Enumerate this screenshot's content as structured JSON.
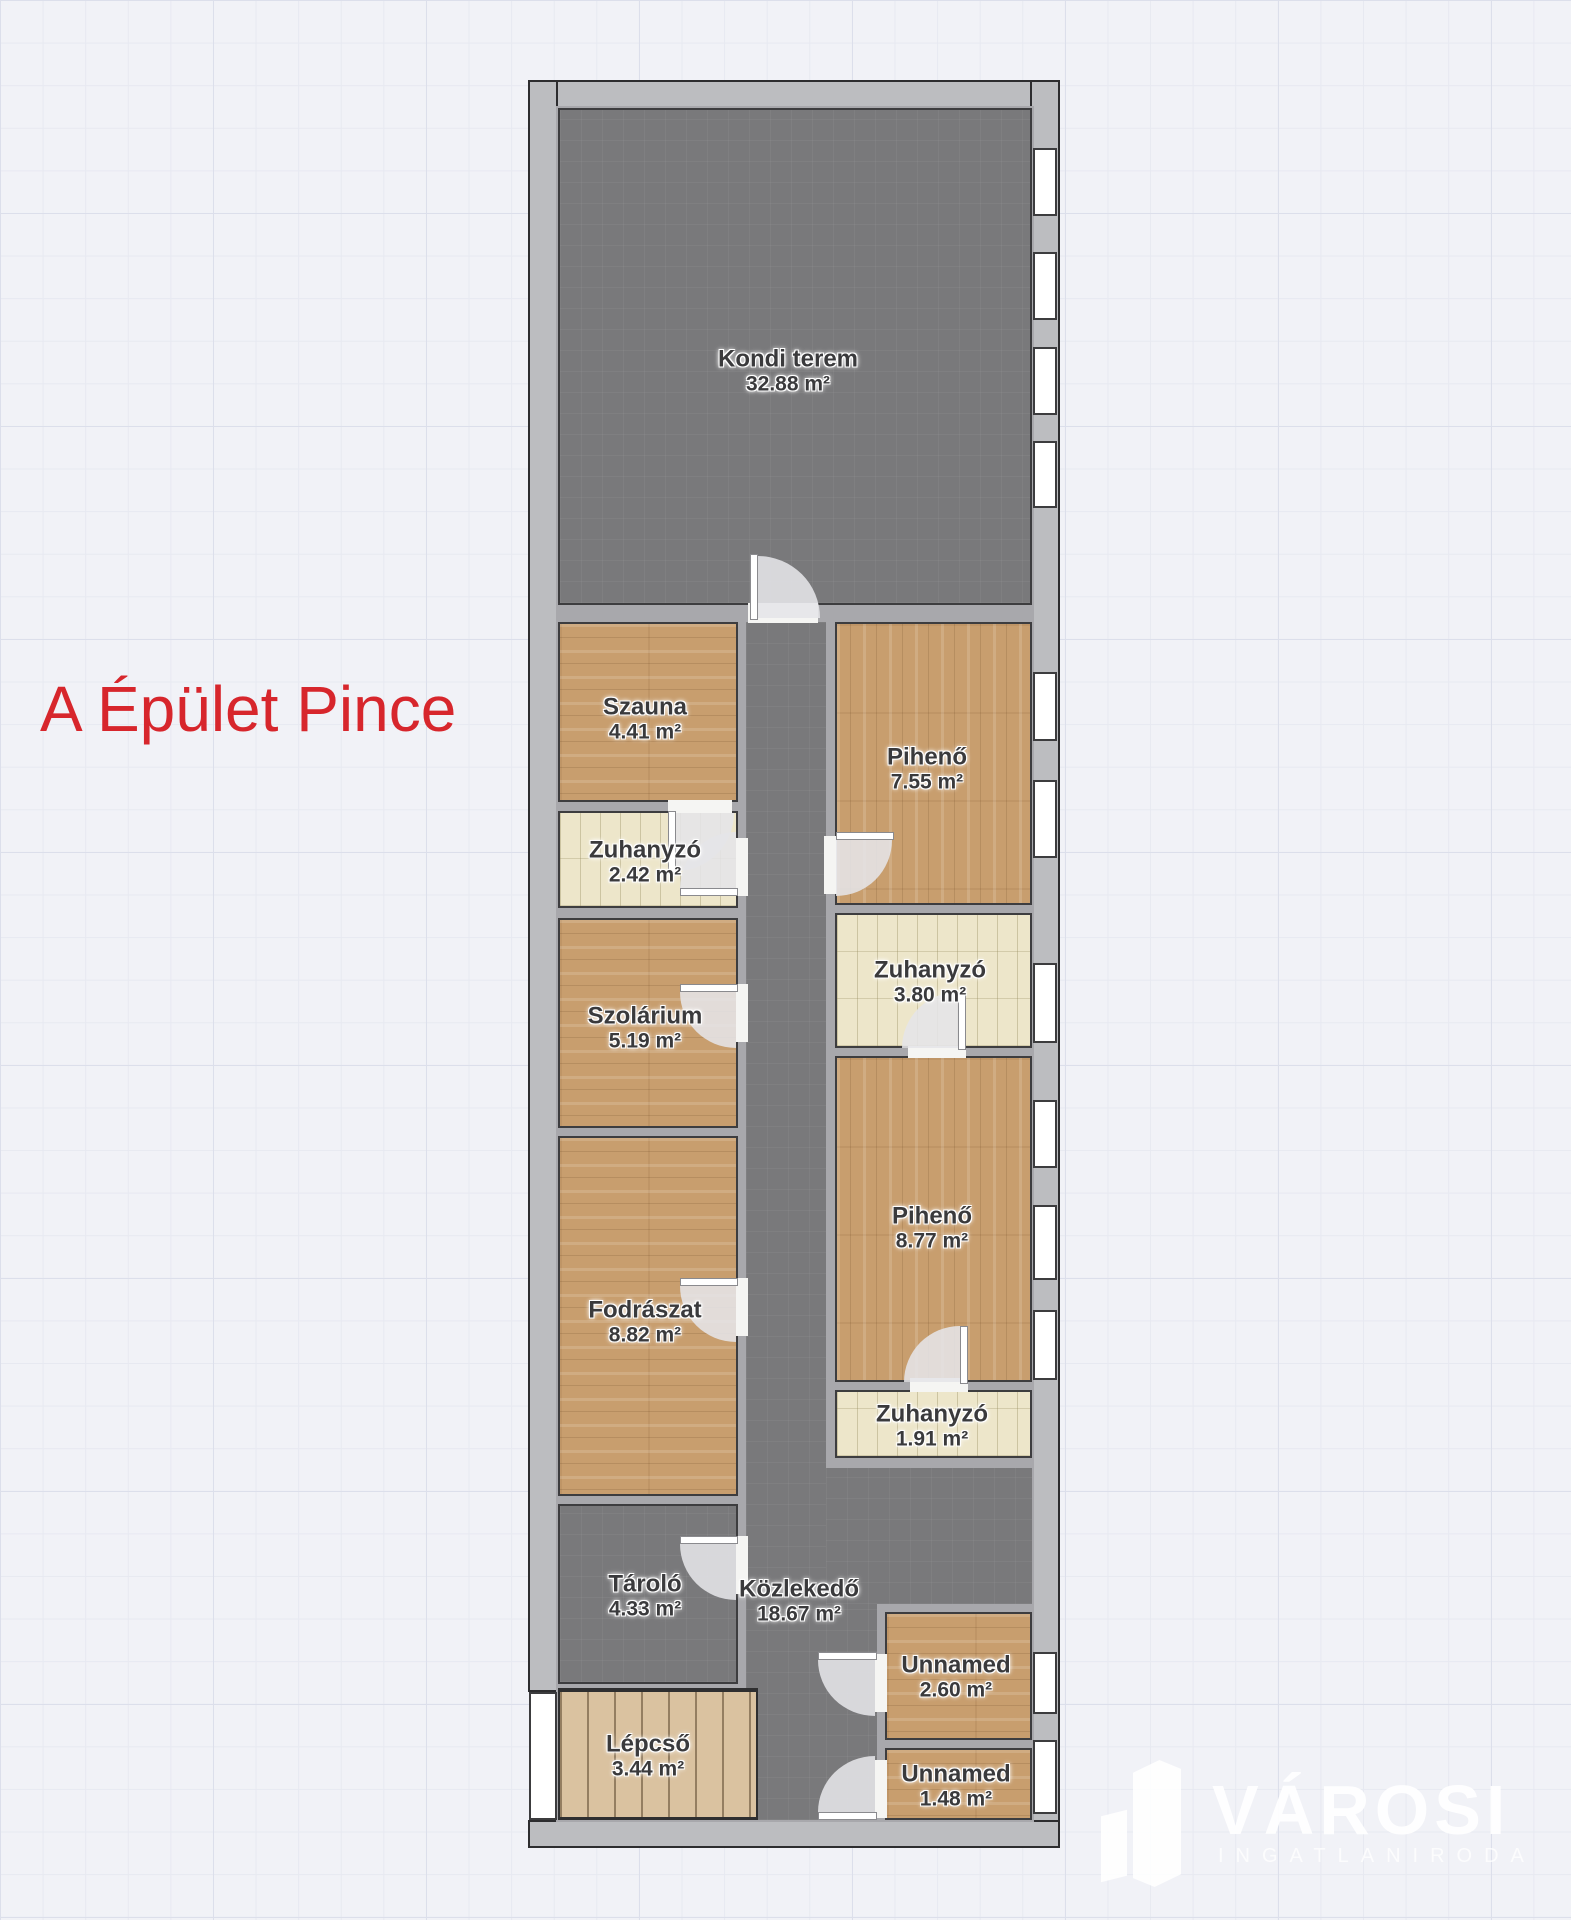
{
  "plan": {
    "title": "A Épület Pince",
    "rooms": [
      {
        "name": "Kondi terem",
        "area": "32.88 m²"
      },
      {
        "name": "Szauna",
        "area": "4.41 m²"
      },
      {
        "name": "Zuhanyzó",
        "area": "2.42 m²"
      },
      {
        "name": "Szolárium",
        "area": "5.19 m²"
      },
      {
        "name": "Fodrászat",
        "area": "8.82 m²"
      },
      {
        "name": "Tároló",
        "area": "4.33 m²"
      },
      {
        "name": "Lépcső",
        "area": "3.44 m²"
      },
      {
        "name": "Pihenő",
        "area": "7.55 m²"
      },
      {
        "name": "Zuhanyzó",
        "area": "3.80 m²"
      },
      {
        "name": "Pihenő",
        "area": "8.77 m²"
      },
      {
        "name": "Zuhanyzó",
        "area": "1.91 m²"
      },
      {
        "name": "Közlekedő",
        "area": "18.67 m²"
      },
      {
        "name": "Unnamed",
        "area": "2.60 m²"
      },
      {
        "name": "Unnamed",
        "area": "1.48 m²"
      }
    ],
    "watermark": {
      "brand": "VÁROSI",
      "subtitle": "INGATLANIRODA"
    },
    "colors": {
      "title_red": "#d7262c",
      "room_dark": "#79797b",
      "room_wood": "#c89e6e",
      "room_tile": "#ede6ca",
      "wall_outer": "#bcbdc0",
      "wall_inner": "#a8a8ac"
    }
  }
}
